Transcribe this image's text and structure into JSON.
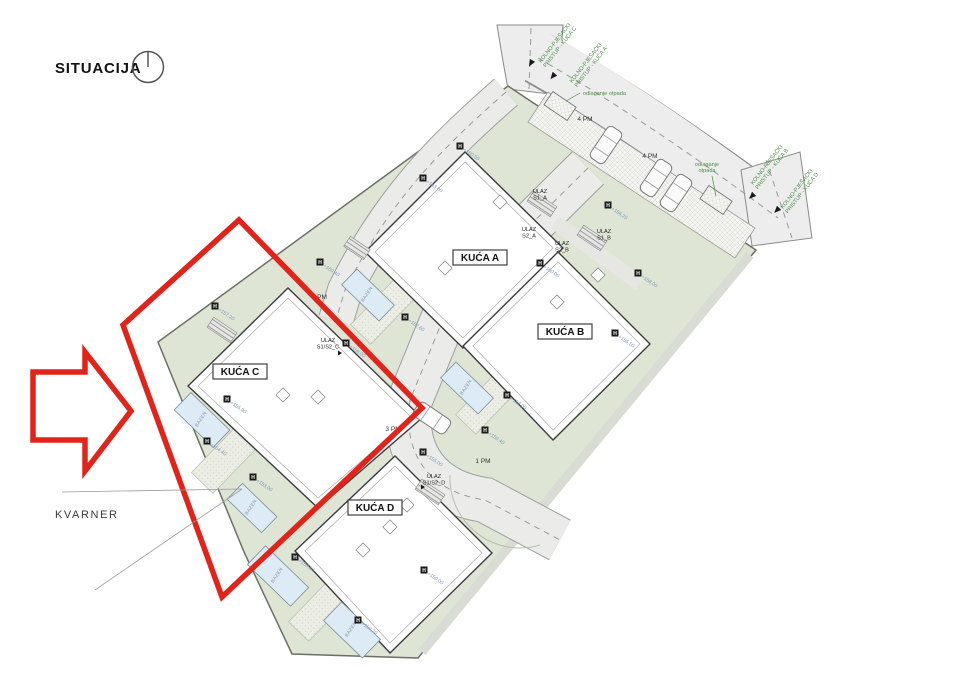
{
  "title": "SITUACIJA",
  "location_label": "KVARNER",
  "marker_symbol": "H",
  "pool_label": "BAZEN",
  "colors": {
    "highlight_red": "#e2231a",
    "access_text_green": "#4e8c4a",
    "parcel_green": "#dfe5d5",
    "road_gray": "#ededee",
    "pool_blue": "#dcebf5",
    "elevation_text_blue": "#7b96bb"
  },
  "access_labels": {
    "c": {
      "line1": "KOLNO-PJEŠAČKI",
      "line2": "PRISTUP - KUĆA C"
    },
    "a": {
      "line1": "KOLNO-PJEŠAČKI",
      "line2": "PRISTUP - KUĆA A"
    },
    "b": {
      "line1": "KOLNO-PJEŠAČKI",
      "line2": "PRISTUP - KUĆA B"
    },
    "d": {
      "line1": "KOLNO-PJEŠAČKI",
      "line2": "PRISTUP - KUĆA D"
    }
  },
  "waste": {
    "label1": "odlaganje otpada",
    "label2_line1": "odlaganje",
    "label2_line2": "otpada"
  },
  "houses": {
    "a": "KUĆA A",
    "b": "KUĆA B",
    "c": "KUĆA C",
    "d": "KUĆA D"
  },
  "entrances": {
    "s1a": {
      "line1": "ULAZ",
      "line2": "S1_A"
    },
    "s2a": {
      "line1": "ULAZ",
      "line2": "S2_A"
    },
    "s2b": {
      "line1": "ULAZ",
      "line2": "S2_B"
    },
    "s1b": {
      "line1": "ULAZ",
      "line2": "S1_B"
    },
    "c": {
      "line1": "ULAZ",
      "line2": "S1/S2_C"
    },
    "d": {
      "line1": "ULAZ",
      "line2": "S1/S2_D"
    }
  },
  "parking": {
    "p4a": "4 PM",
    "p4b": "4 PM",
    "pm": "PM",
    "p3": "3 PM",
    "p1": "1 PM"
  },
  "markers": [
    {
      "value": "+163,00"
    },
    {
      "value": "+160,50"
    },
    {
      "value": "+160,40"
    },
    {
      "value": "+157,20"
    },
    {
      "value": "+156,20"
    },
    {
      "value": "+160,00"
    },
    {
      "value": "+158,00"
    },
    {
      "value": "+156,50"
    },
    {
      "value": "+152,00"
    },
    {
      "value": "+162,60"
    },
    {
      "value": "+156,00"
    },
    {
      "value": "+155,90"
    },
    {
      "value": "+154,40"
    },
    {
      "value": "+153,00"
    },
    {
      "value": "+150,60"
    },
    {
      "value": "+150,20"
    },
    {
      "value": "+150,00"
    },
    {
      "value": "+150,40"
    },
    {
      "value": "+155,00"
    }
  ]
}
